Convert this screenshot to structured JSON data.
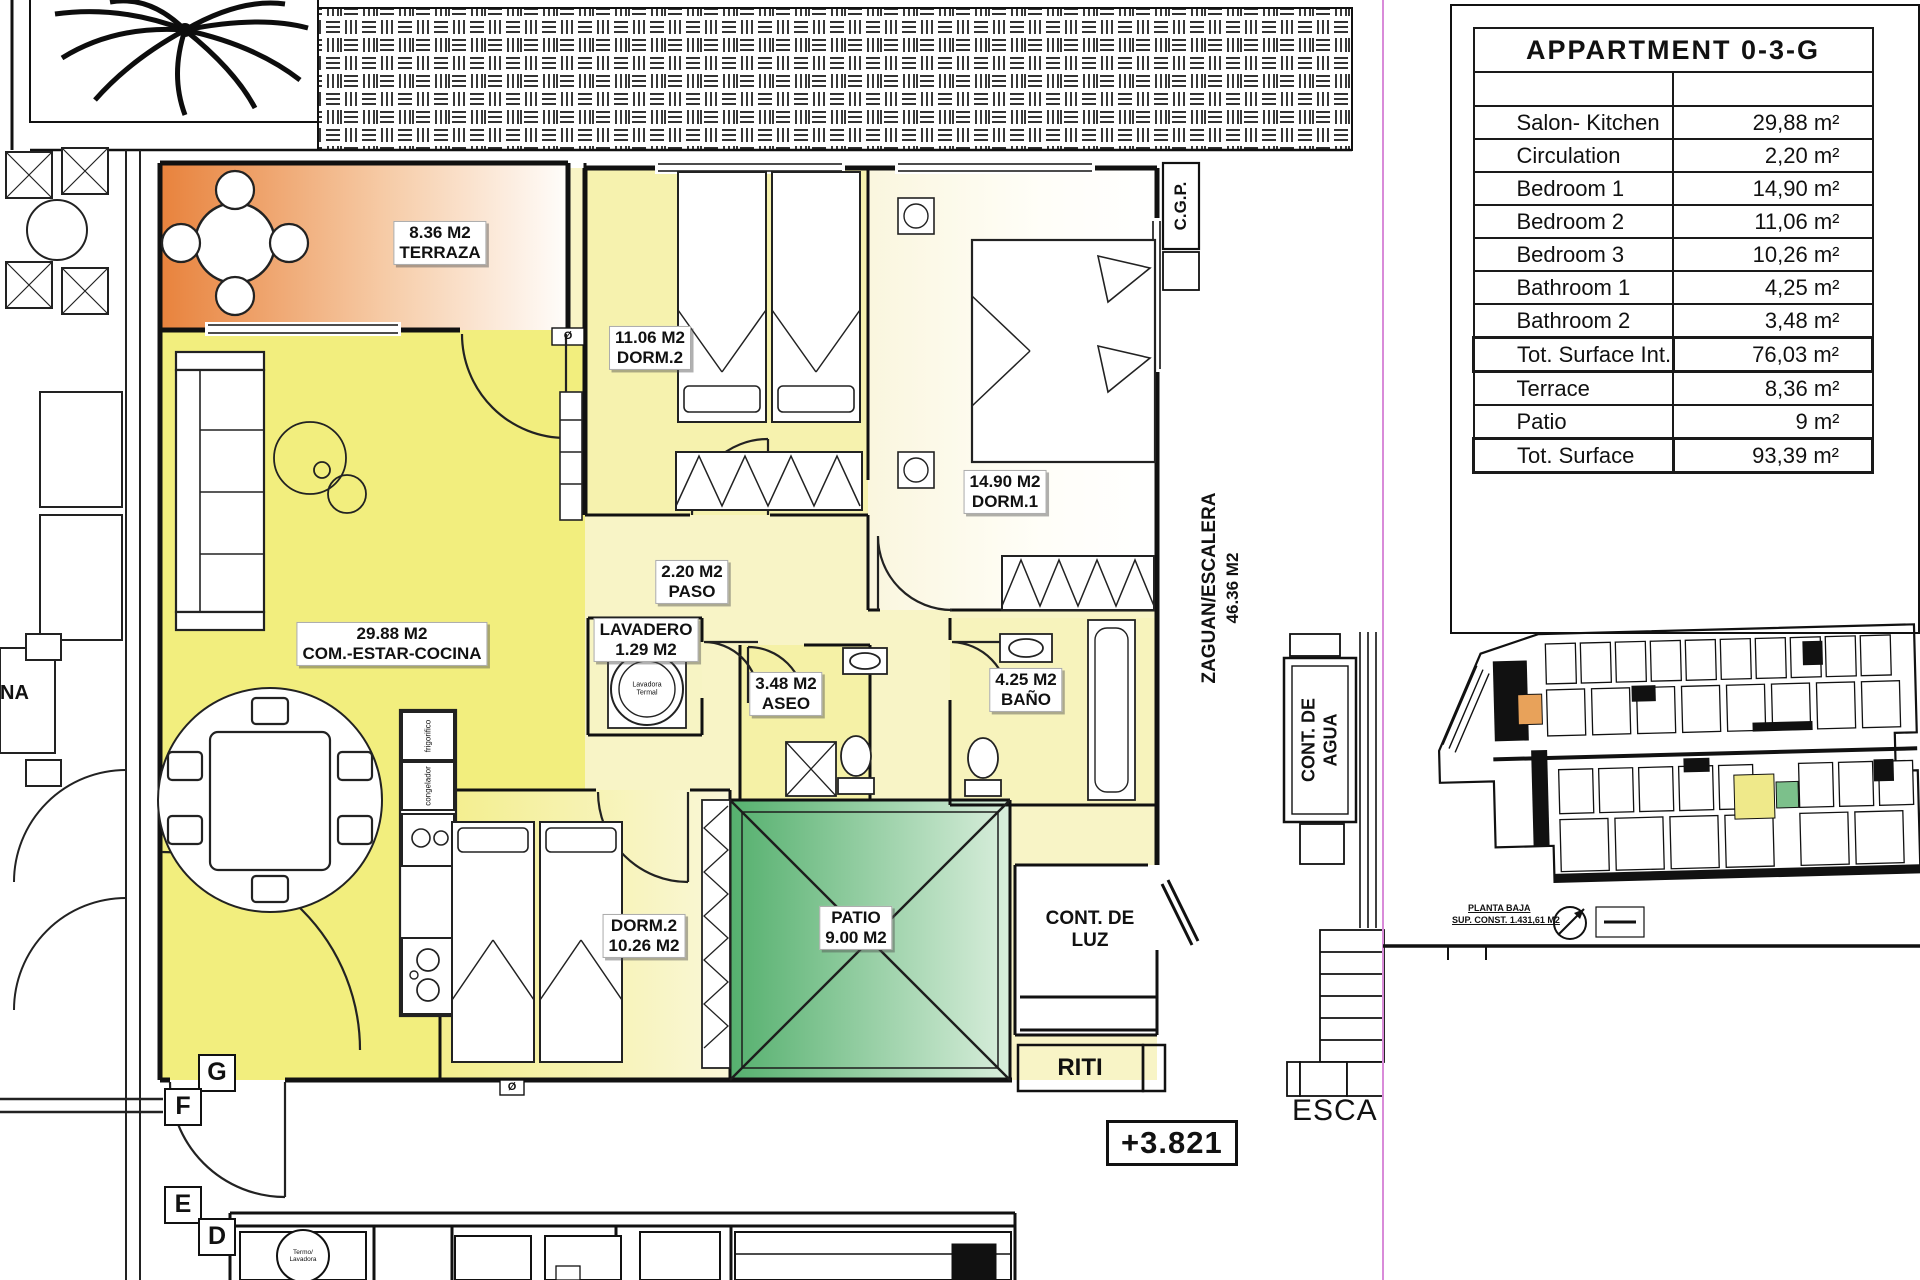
{
  "table": {
    "title": "APPARTMENT 0-3-G",
    "rows": [
      {
        "label": "Salon- Kitchen",
        "value": "29,88 m²"
      },
      {
        "label": "Circulation",
        "value": "2,20 m²"
      },
      {
        "label": "Bedroom 1",
        "value": "14,90 m²"
      },
      {
        "label": "Bedroom 2",
        "value": "11,06 m²"
      },
      {
        "label": "Bedroom 3",
        "value": "10,26 m²"
      },
      {
        "label": "Bathroom 1",
        "value": "4,25 m²"
      },
      {
        "label": "Bathroom 2",
        "value": "3,48 m²"
      },
      {
        "label": "Tot. Surface Int.",
        "value": "76,03 m²"
      },
      {
        "label": "Terrace",
        "value": "8,36 m²"
      },
      {
        "label": "Patio",
        "value": "9 m²"
      },
      {
        "label": "Tot. Surface",
        "value": "93,39 m²"
      }
    ]
  },
  "plan": {
    "labels": {
      "terraza": [
        "8.36 M2",
        "TERRAZA"
      ],
      "dorm2top": [
        "11.06 M2",
        "DORM.2"
      ],
      "dorm1": [
        "14.90 M2",
        "DORM.1"
      ],
      "paso": [
        "2.20 M2",
        "PASO"
      ],
      "lavadero": [
        "LAVADERO",
        "1.29 M2"
      ],
      "aseo": [
        "3.48 M2",
        "ASEO"
      ],
      "bano": [
        "4.25 M2",
        "BAÑO"
      ],
      "salon": [
        "29.88 M2",
        "COM.-ESTAR-COCINA"
      ],
      "dorm3": [
        "DORM.2",
        "10.26 M2"
      ],
      "patio": [
        "PATIO",
        "9.00 M2"
      ]
    },
    "annotations": {
      "cgp": "C.G.P.",
      "zaguan": [
        "ZAGUAN/ESCALERA",
        "46.36 M2"
      ],
      "cont_agua": [
        "CONT. DE",
        "AGUA"
      ],
      "cont_luz": [
        "CONT. DE",
        "LUZ"
      ],
      "riti": "RITI",
      "esca": "ESCA",
      "level": "+3.821",
      "na": "NA"
    },
    "grid": {
      "g": "G",
      "f": "F",
      "e": "E",
      "d": "D"
    },
    "tiny": {
      "fridge": "frigorifico",
      "freezer": "congelador",
      "washer": [
        "Lavadora",
        "Termal"
      ],
      "boiler": [
        "Termo/",
        "Lavadora"
      ],
      "drain": "Ø"
    }
  },
  "minimap": {
    "caption": [
      "PLANTA BAJA",
      "SUP. CONST. 1.431,61 M2"
    ]
  },
  "colors": {
    "terrace_orange": "#E8823C",
    "living_yellow": "#F2EE7E",
    "bedroom_pale": "#F6F2AE",
    "patio_green": "#55B06E",
    "plan_line": "#111111",
    "magenta_guide": "#D98BD9"
  }
}
